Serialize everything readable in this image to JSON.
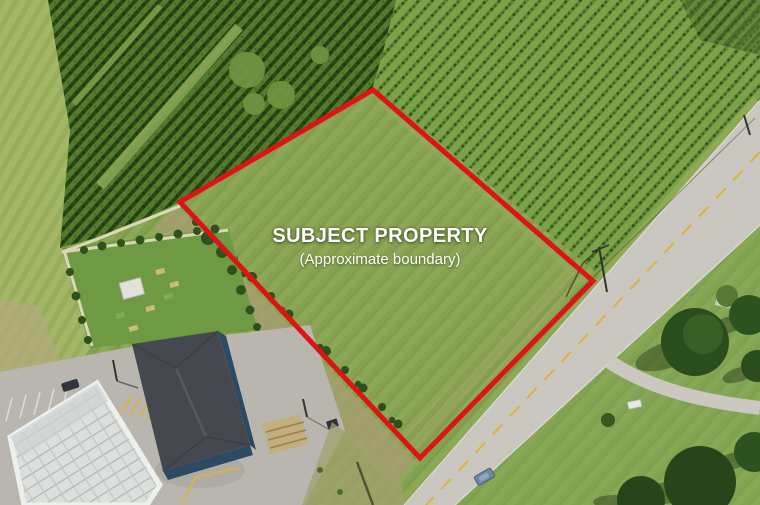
{
  "scene": {
    "type": "aerial-photo",
    "label": {
      "title": "SUBJECT PROPERTY",
      "subtitle": "(Approximate boundary)"
    },
    "boundary": {
      "points": "373,90 180,202 420,458 593,281",
      "color": "#de1316",
      "stroke_width": 5
    },
    "palette": {
      "grass": "#84a150",
      "dense_trees": "#2c4a16",
      "sparse_trees": "#5f8438",
      "road": "#cac7c1",
      "road_centerline": "#d9b445",
      "label_text": "#ffffff"
    }
  }
}
